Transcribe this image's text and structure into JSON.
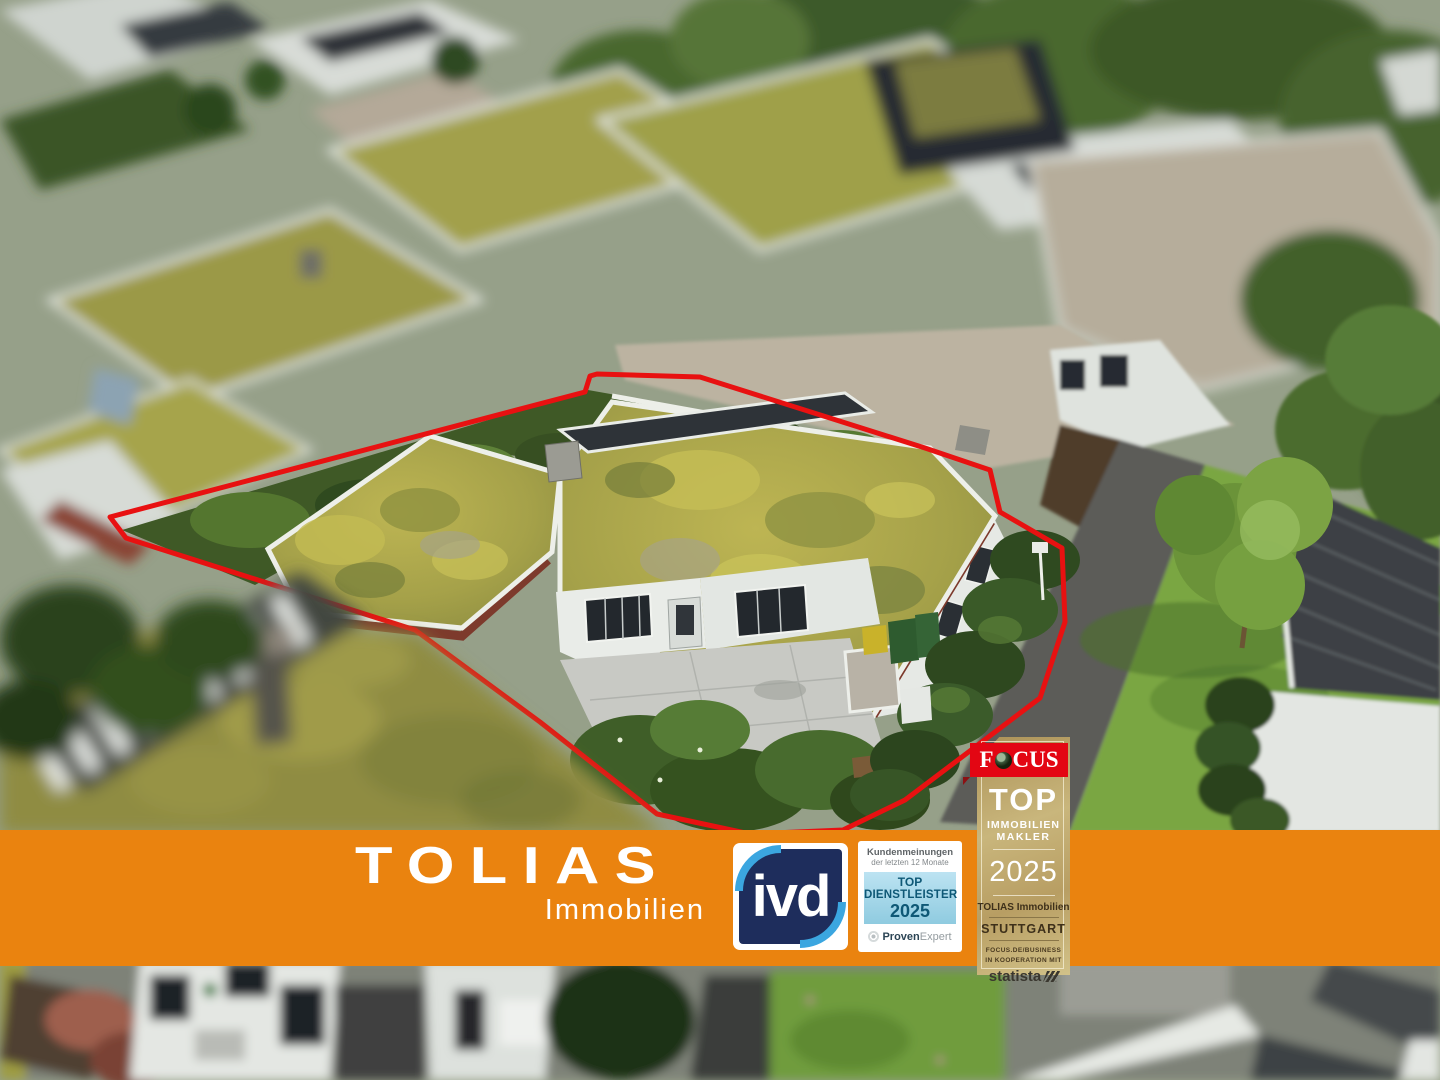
{
  "banner": {
    "brand": "TOLIAS",
    "brand_sub": "Immobilien",
    "background_color": "#EA830F"
  },
  "badges": {
    "ivd": {
      "label": "ivd",
      "navy_color": "#1E2D5C",
      "swoosh_color": "#3BA6E0"
    },
    "proven_expert": {
      "line1": "Kundenmeinungen",
      "line2": "der letzten 12 Monate",
      "award_line1": "TOP",
      "award_line2": "DIENSTLEISTER",
      "award_year": "2025",
      "logo_bold": "Proven",
      "logo_light": "Expert",
      "box_text_color": "#0E5876"
    },
    "focus": {
      "logo_f": "F",
      "logo_cus": "CUS",
      "award_line1": "TOP",
      "award_line2": "IMMOBILIEN",
      "award_line3": "MAKLER",
      "year": "2025",
      "recipient": "TOLIAS Immobilien",
      "city": "STUTTGART",
      "footnote1": "FOCUS.DE/BUSINESS",
      "footnote2": "IN KOOPERATION MIT",
      "partner": "statista",
      "red_color": "#E30613",
      "gold_color": "#C9B67C"
    }
  },
  "photo": {
    "outline_color": "#E81111"
  }
}
